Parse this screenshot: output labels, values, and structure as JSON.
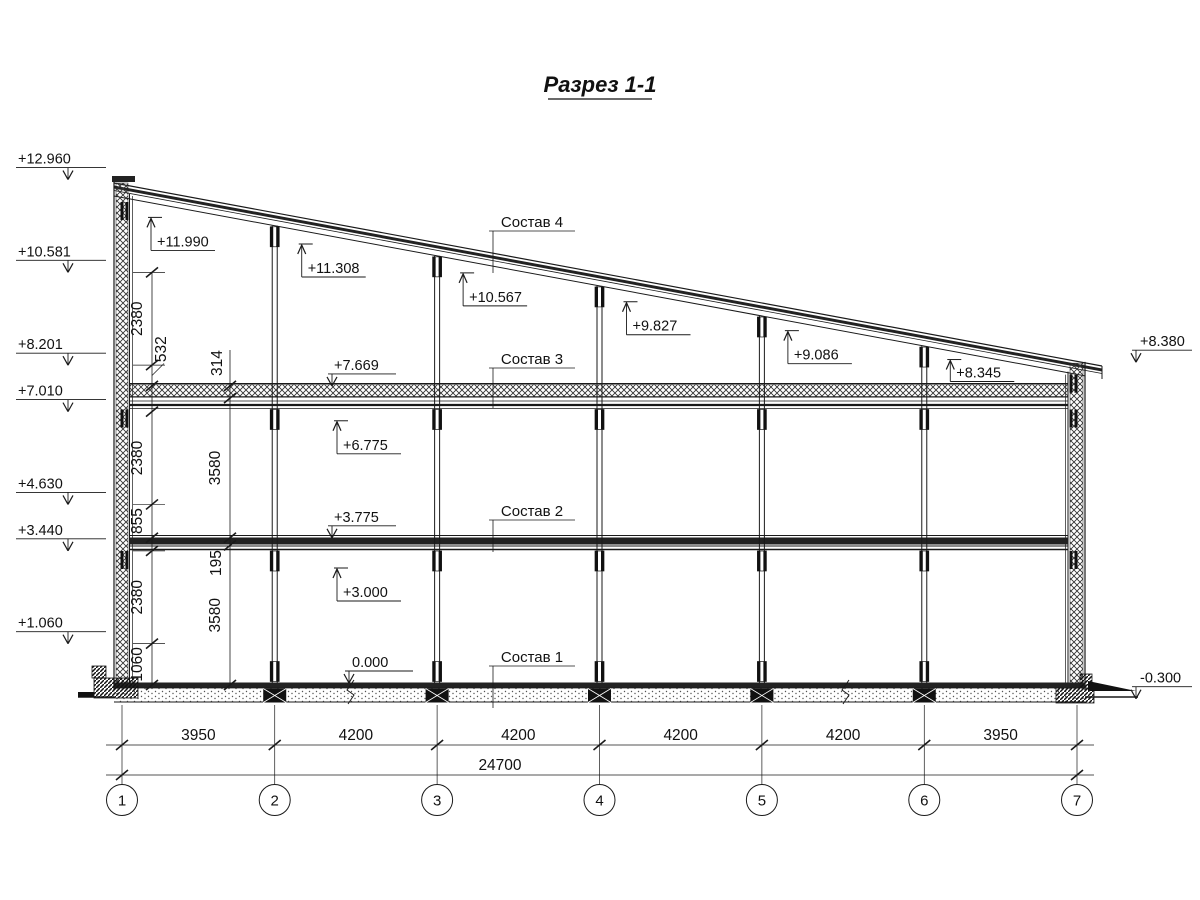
{
  "title": {
    "text": "Разрез 1-1"
  },
  "section": {
    "composition_labels": [
      {
        "label": "Состав 4",
        "target": "roof"
      },
      {
        "label": "Состав 3",
        "target": "slab3"
      },
      {
        "label": "Состав 2",
        "target": "slab2"
      },
      {
        "label": "Состав 1",
        "target": "floor"
      }
    ],
    "elevation_marks": {
      "left": [
        {
          "label": "+12.960",
          "mm": 12960
        },
        {
          "label": "+10.581",
          "mm": 10581
        },
        {
          "label": "+8.201",
          "mm": 8201
        },
        {
          "label": "+7.010",
          "mm": 7010
        },
        {
          "label": "+4.630",
          "mm": 4630
        },
        {
          "label": "+3.440",
          "mm": 3440
        },
        {
          "label": "+1.060",
          "mm": 1060
        }
      ],
      "right": [
        {
          "label": "+8.380",
          "mm": 8380
        },
        {
          "label": "-0.300",
          "mm": -300
        }
      ],
      "roof": [
        {
          "label": "+11.990",
          "mm": 11990,
          "axis_index": 0
        },
        {
          "label": "+11.308",
          "mm": 11308,
          "axis_index": 1
        },
        {
          "label": "+10.567",
          "mm": 10567,
          "axis_index": 2
        },
        {
          "label": "+9.827",
          "mm": 9827,
          "axis_index": 3
        },
        {
          "label": "+9.086",
          "mm": 9086,
          "axis_index": 4
        },
        {
          "label": "+8.345",
          "mm": 8345,
          "axis_index": 5
        }
      ],
      "floors_down": [
        {
          "label": "+7.669",
          "mm": 7669
        },
        {
          "label": "+3.775",
          "mm": 3775
        },
        {
          "label": "0.000",
          "mm": 0
        }
      ],
      "floors_up": [
        {
          "label": "+6.775",
          "mm": 6775
        },
        {
          "label": "+3.000",
          "mm": 3000
        }
      ]
    },
    "vertical_dimensions": {
      "inner_chain": [
        {
          "label": "2380",
          "from_mm": 8201,
          "to_mm": 10581
        },
        {
          "label": "532",
          "from_mm": 7669,
          "to_mm": 8201,
          "leader": true
        },
        {
          "label": "2380",
          "from_mm": 4630,
          "to_mm": 7010
        },
        {
          "label": "855",
          "from_mm": 3775,
          "to_mm": 4630
        },
        {
          "label": "2380",
          "from_mm": 1060,
          "to_mm": 3440
        },
        {
          "label": "1060",
          "from_mm": 0,
          "to_mm": 1060
        }
      ],
      "outer_chain": [
        {
          "label": "314",
          "from_mm": 7355,
          "to_mm": 7669,
          "above": true
        },
        {
          "label": "3580",
          "from_mm": 3775,
          "to_mm": 7355
        },
        {
          "label": "195",
          "from_mm": 3580,
          "to_mm": 3775,
          "below": true
        },
        {
          "label": "3580",
          "from_mm": 0,
          "to_mm": 3580
        }
      ]
    },
    "horizontal_dimensions": {
      "spans": [
        {
          "label": "3950",
          "mm": 3950
        },
        {
          "label": "4200",
          "mm": 4200
        },
        {
          "label": "4200",
          "mm": 4200
        },
        {
          "label": "4200",
          "mm": 4200
        },
        {
          "label": "4200",
          "mm": 4200
        },
        {
          "label": "3950",
          "mm": 3950
        }
      ],
      "total": {
        "label": "24700",
        "mm": 24700
      }
    },
    "axes": [
      {
        "label": "1"
      },
      {
        "label": "2"
      },
      {
        "label": "3"
      },
      {
        "label": "4"
      },
      {
        "label": "5"
      },
      {
        "label": "6"
      },
      {
        "label": "7"
      }
    ]
  }
}
